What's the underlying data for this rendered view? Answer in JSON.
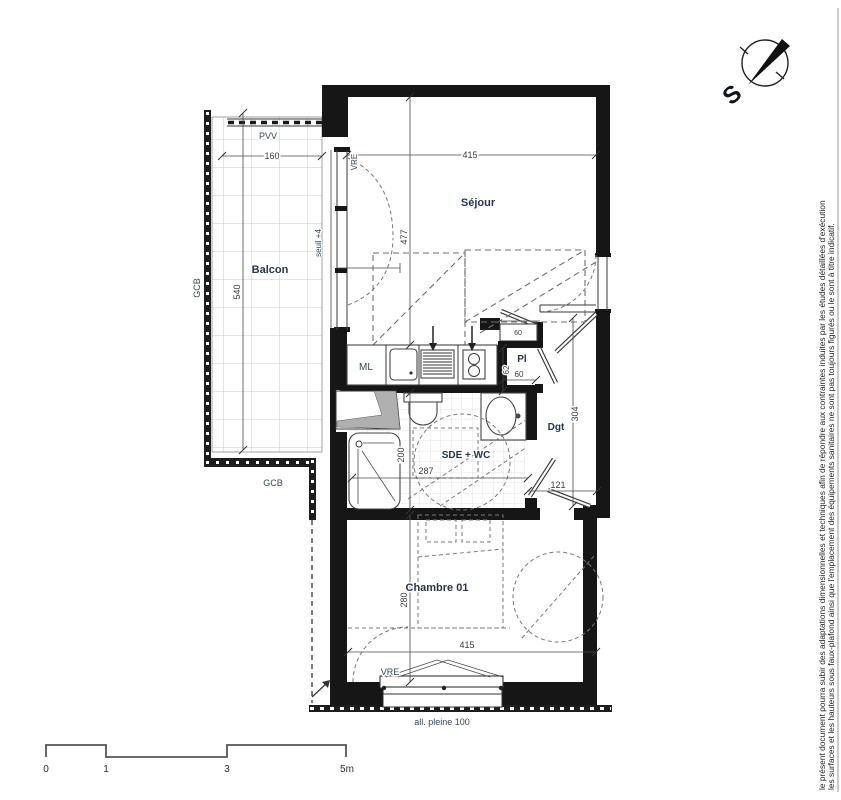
{
  "rooms": {
    "balcon": "Balcon",
    "sejour": "Séjour",
    "sde_wc": "SDE + WC",
    "chambre": "Chambre 01",
    "dgt": "Dgt",
    "placard": "Pl",
    "ml": "ML"
  },
  "annotations": {
    "pvv": "PVV",
    "vre_top": "VRE",
    "vre_bottom": "VRE",
    "gcb_left": "GCB",
    "gcb_bottom": "GCB",
    "seuil": "seuil +4",
    "allege": "all. pleine 100",
    "shelf_width": "60"
  },
  "dimensions": {
    "balcony_width": "160",
    "balcony_depth": "540",
    "sejour_width": "415",
    "sejour_depth": "477",
    "placard_depth": "62",
    "placard_width": "60",
    "dgt_depth": "304",
    "dgt_width": "121",
    "sde_depth": "200",
    "sde_width": "287",
    "chambre_depth": "280",
    "chambre_width": "415"
  },
  "compass": {
    "south_label": "S"
  },
  "scale_bar": {
    "ticks": [
      "0",
      "1",
      "3",
      "5m"
    ]
  },
  "disclaimer": {
    "line1": "le présent document pourra subir des adaptations dimensionnelles et techniques afin de répondre aux contraintes induites par les études détaillées d'exécution",
    "line2": "les surfaces et les hauteurs sous faux-plafond ainsi que l'emplacement des équipements sanitaires ne sont pas toujours figurés ou le sont à titre indicatif."
  },
  "colors": {
    "wall": "#161616",
    "room_label": "#25364a",
    "dimension_text": "#3c3c3c",
    "balcony_grid": "#c9c9c9",
    "tile_grid": "#dcdcdc",
    "dashed_line": "#6e6e6e",
    "duct_poche": "#b0b0b0"
  }
}
